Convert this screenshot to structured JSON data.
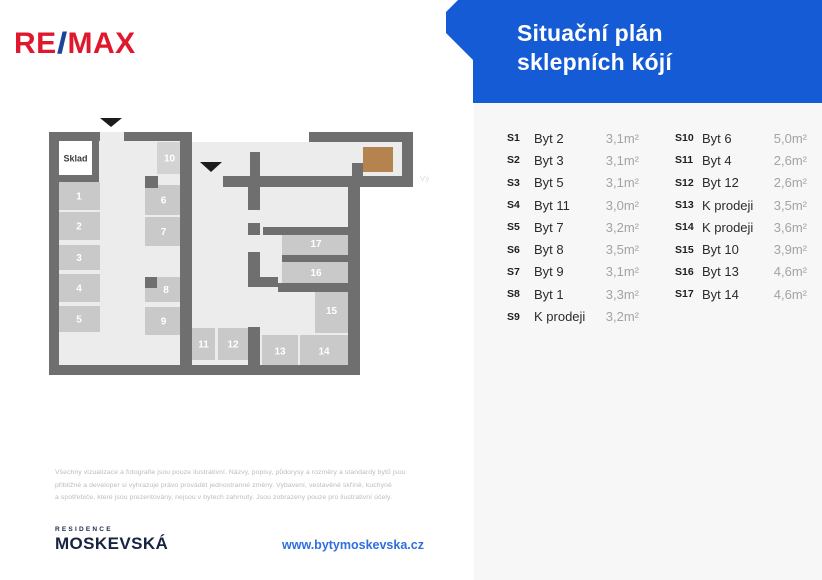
{
  "colors": {
    "accent_blue": "#155bd5",
    "remax_red": "#e0182d",
    "remax_slash_blue": "#1b4598",
    "elevator_brown": "#b5834d",
    "brand_navy": "#16243f",
    "link_blue": "#2f6fe0",
    "wall_gray": "#6f6f6f",
    "cell_gray": "#c9c9c9"
  },
  "brand": {
    "re": "RE",
    "slash": "/",
    "max": "MAX"
  },
  "header": {
    "title_line1": "Situační plán",
    "title_line2": "sklepních kójí"
  },
  "plan": {
    "sklad_label": "Sklad",
    "elevator_label": "Výtah",
    "cell_numbers": [
      "1",
      "2",
      "3",
      "4",
      "5",
      "6",
      "7",
      "8",
      "9",
      "10",
      "11",
      "12",
      "13",
      "14",
      "15",
      "16",
      "17"
    ]
  },
  "table": {
    "col1": [
      {
        "code": "S1",
        "name": "Byt 2",
        "area": "3,1m²"
      },
      {
        "code": "S2",
        "name": "Byt 3",
        "area": "3,1m²"
      },
      {
        "code": "S3",
        "name": "Byt 5",
        "area": "3,1m²"
      },
      {
        "code": "S4",
        "name": "Byt 11",
        "area": "3,0m²"
      },
      {
        "code": "S5",
        "name": "Byt 7",
        "area": "3,2m²"
      },
      {
        "code": "S6",
        "name": "Byt 8",
        "area": "3,5m²"
      },
      {
        "code": "S7",
        "name": "Byt 9",
        "area": "3,1m²"
      },
      {
        "code": "S8",
        "name": "Byt 1",
        "area": "3,3m²"
      },
      {
        "code": "S9",
        "name": "K prodeji",
        "area": "3,2m²"
      }
    ],
    "col2": [
      {
        "code": "S10",
        "name": "Byt 6",
        "area": "5,0m²"
      },
      {
        "code": "S11",
        "name": "Byt 4",
        "area": "2,6m²"
      },
      {
        "code": "S12",
        "name": "Byt 12",
        "area": "2,6m²"
      },
      {
        "code": "S13",
        "name": "K prodeji",
        "area": "3,5m²"
      },
      {
        "code": "S14",
        "name": "K prodeji",
        "area": "3,6m²"
      },
      {
        "code": "S15",
        "name": "Byt 10",
        "area": "3,9m²"
      },
      {
        "code": "S16",
        "name": "Byt 13",
        "area": "4,6m²"
      },
      {
        "code": "S17",
        "name": "Byt 14",
        "area": "4,6m²"
      }
    ]
  },
  "disclaimer": {
    "line1": "Všechny vizualizace a fotografie jsou pouze ilustrativní. Názvy, popisy, půdorysy a rozměry a standardy bytů jsou",
    "line2": "přibližné a developer si vyhrazuje právo provádět jednostranné změny. Vybavení, vestavěné skříně, kuchyně",
    "line3": "a spotřebiče, které jsou prezentovány, nejsou v bytech zahrnuty. Jsou zobrazeny pouze pro ilustrativní účely."
  },
  "footer": {
    "residence": "RESIDENCE",
    "project": "MOSKEVSKÁ",
    "url": "www.bytymoskevska.cz"
  }
}
